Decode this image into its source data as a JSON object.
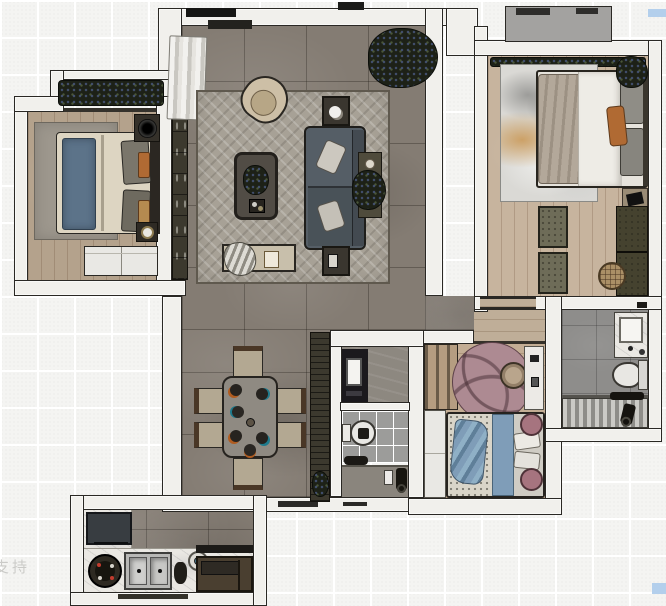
{
  "title": "apartment-floor-plan-render",
  "watermark": {
    "text": "支持"
  },
  "palette": {
    "outside": "#f4f4f2",
    "grid": "#ffffff",
    "wall": "#f1f0ec",
    "outline": "#2a2824",
    "tileFloor": "#847c73",
    "woodMaster": "#c7b49e",
    "woodBed2": "#b4a28c",
    "woodKid": "#c3ad94",
    "woodVest": "#bfae98",
    "rugLiving": "#a7a196",
    "rugBed2": "#9d978d",
    "rugMaster": "#dad9d5",
    "rugKid": "#ad8a92",
    "sofa": "#555e66",
    "armchair": "#cdbfa6",
    "benchTan": "#c8bfab",
    "duvetCream": "#ddd5c2",
    "runnerBlue": "#5c7389",
    "kidBlue": "#7f9db8",
    "kidPink": "#a6747f",
    "accentOrange": "#b06a33",
    "oliveDark": "#3c392e",
    "oliveBench": "#6e6c58",
    "plantDark": "#1d2117",
    "marble": "#eae8e3",
    "steel": "#b8b8b6",
    "applianceDark": "#383d41",
    "ledge": "#a3a2a0",
    "tileBath": "#9c9c9a",
    "tileBathBig": "#8e8d8b",
    "blueMark": "#b3cfec",
    "watermark": "#c6c6c3"
  },
  "rooms": [
    {
      "name": "secondary-bedroom",
      "furniture": [
        "balcony-plants",
        "area-rug",
        "double-bed",
        "blue-runner",
        "pillows",
        "nightstand-speaker",
        "tray",
        "white-wardrobe"
      ]
    },
    {
      "name": "living-room",
      "furniture": [
        "curtain",
        "tv-cabinet",
        "herringbone-rug",
        "armchair",
        "coffee-table",
        "sofa",
        "throw-pillows",
        "plant-large",
        "side-table-plant",
        "end-table-top",
        "end-table-bottom",
        "bench-clothes"
      ]
    },
    {
      "name": "dining-area",
      "furniture": [
        "dining-table",
        "dining-chair-x6",
        "place-settings",
        "sideboard",
        "floor-plant"
      ]
    },
    {
      "name": "master-bedroom",
      "furniture": [
        "ac-ledge",
        "plant-strip",
        "art-rug",
        "double-bed",
        "orange-pillow",
        "nightstand",
        "bench-x2",
        "wardrobe",
        "rattan-pouf",
        "corner-plant"
      ]
    },
    {
      "name": "kids-bedroom",
      "furniture": [
        "sliding-wardrobe",
        "round-pink-rug",
        "pouf",
        "white-desk",
        "white-wardrobe",
        "bed-speckled",
        "blue-throw",
        "pink-pillows"
      ]
    },
    {
      "name": "bathroom-main",
      "furniture": [
        "dark-vanity-mirror",
        "toilet",
        "bath-mat",
        "shower-set"
      ]
    },
    {
      "name": "bathroom-ensuite",
      "furniture": [
        "marble-vanity-sink",
        "toilet",
        "slatted-shower",
        "shower-set"
      ]
    },
    {
      "name": "kitchen",
      "furniture": [
        "fridge",
        "marble-counter",
        "cooktop",
        "double-sink",
        "grinder",
        "bowl",
        "hood-bar",
        "dark-cabinet"
      ]
    }
  ],
  "marks": {
    "blue_rect_top_right": true,
    "blue_rect_bottom_right": true,
    "entry_thresholds": 2
  }
}
